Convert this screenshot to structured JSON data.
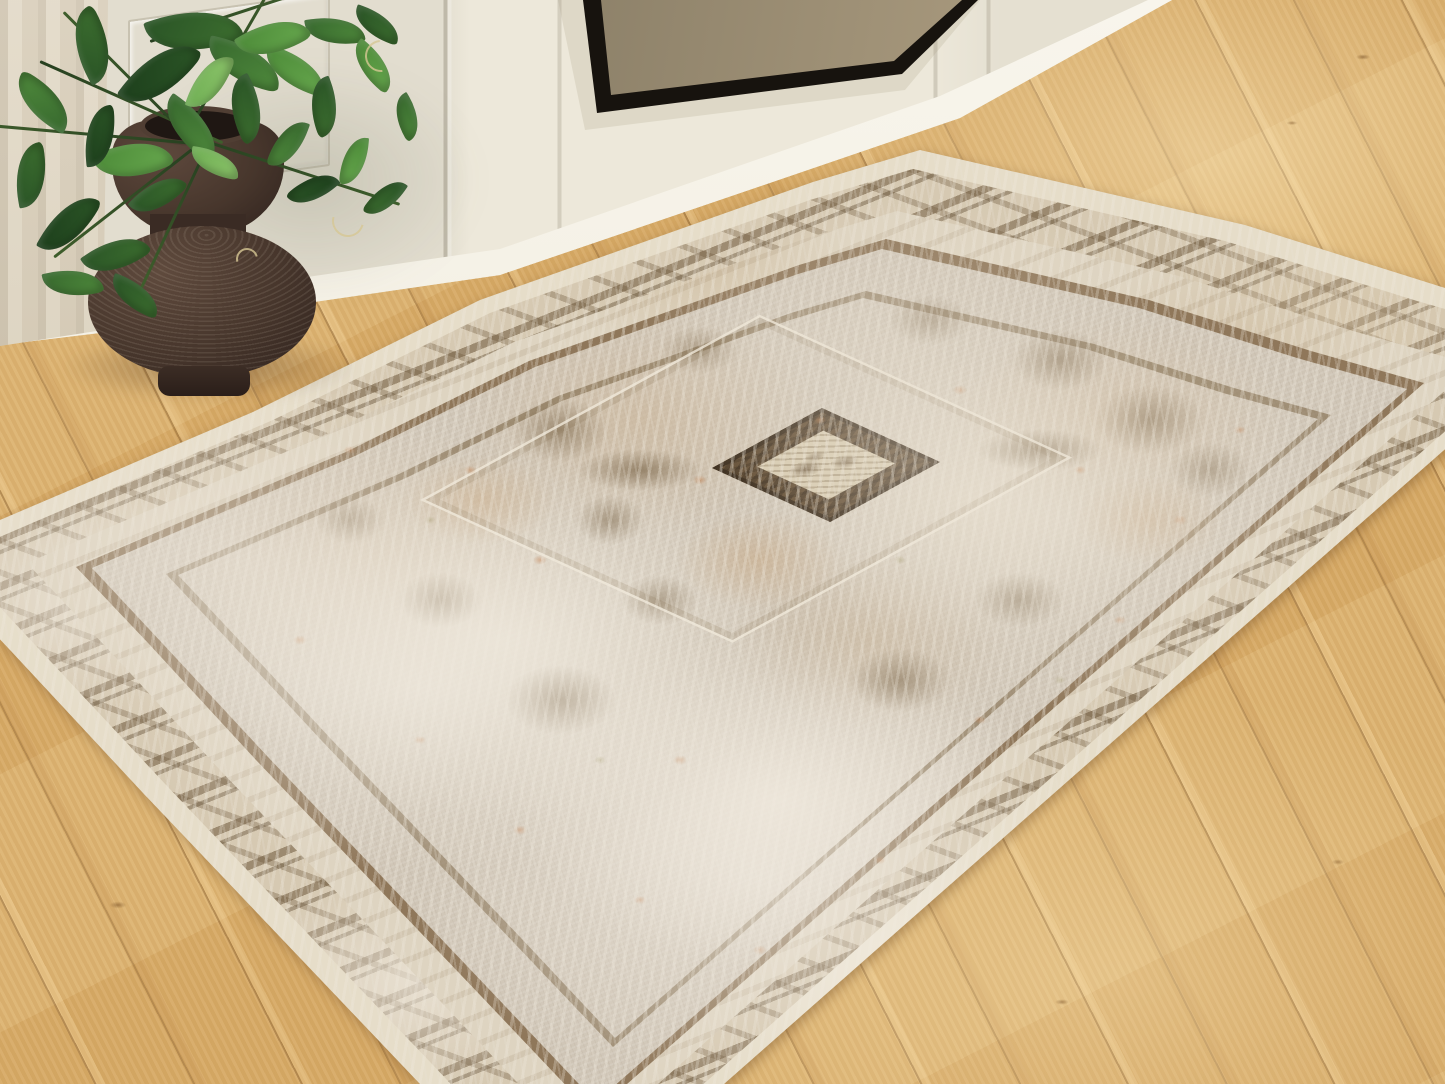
{
  "scene": {
    "type": "interior lifestyle product photograph",
    "subject": "distressed vintage-style medallion area rug with cream, tan, brown and faint rust tones",
    "setting": "light oak plank floor in front of a white paneled fireplace wall",
    "objects": [
      "area-rug",
      "rug-center-medallion",
      "rug-border-band",
      "wood-floor",
      "white-paneled-wall",
      "baseboard",
      "framed-artwork-corner",
      "linen-curtain",
      "brown-ceramic-vase",
      "pothos-plant"
    ]
  },
  "palette": {
    "floor-base": "#d9ad68",
    "floor-light": "#ecd09c",
    "wall": "#ece7d8",
    "baseboard": "#f8f5ec",
    "curtain": "#d3c7b0",
    "frame": "#17130e",
    "canvas-bronze": "#b0a083",
    "rug-ground": "#cfc5b6",
    "rug-pale": "#e6ddc9",
    "rug-brown": "#6e5941",
    "rug-tan": "#c4a98b",
    "rug-rust": "#bd7e51",
    "medallion": "#665138",
    "vase": "#47362c",
    "vase-dark": "#2f221d",
    "leaf-dark": "#1d3f1c",
    "leaf-mid": "#3c6e2f",
    "leaf-bright": "#4f8a3c",
    "leaf-light": "#67a84e",
    "leaf-pale": "#8cc46a"
  }
}
